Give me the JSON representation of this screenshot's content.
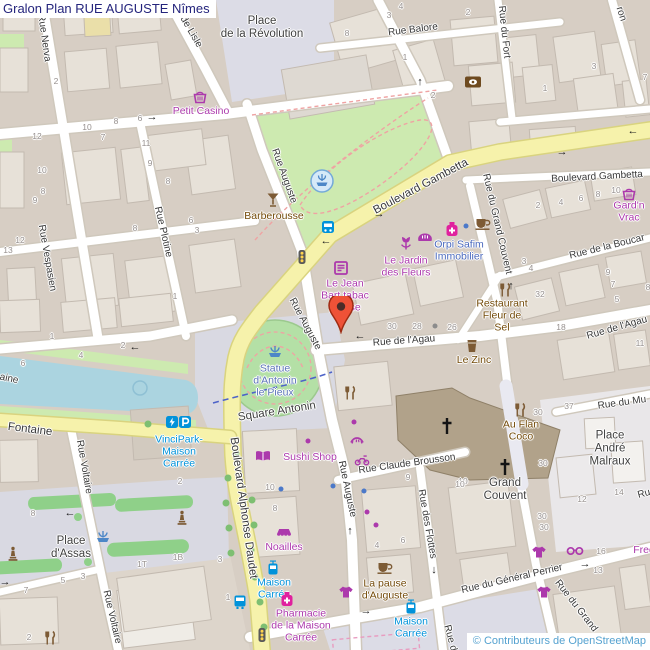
{
  "header": {
    "title": "Gralon Plan RUE AUGUSTE Nîmes"
  },
  "attribution": {
    "text": "© Contributeurs de OpenStreetMap"
  },
  "palette": {
    "shop": "#ac39ac",
    "amenity": "#734a08",
    "transit": "#0092da",
    "office": "#4a69bd",
    "tourism": "#5b74b8",
    "place": "#3f3f3f",
    "street": "#383838",
    "major": "#383838",
    "number": "#97918f",
    "title": "#24247c",
    "attribution": "#55a2d0",
    "road_major": "#f6f2ab",
    "water": "#abd4e0",
    "park": "#cdeab0",
    "plaza": "#dcdce6",
    "marker": "#ee5237"
  },
  "marker": {
    "name": "location-marker",
    "x": 341,
    "y": 332
  },
  "streets": [
    {
      "t": "Rue Nerva",
      "x": 44,
      "y": 38,
      "r": 82
    },
    {
      "t": "de Lisle",
      "x": 191,
      "y": 32,
      "r": 60
    },
    {
      "t": "Rue Balore",
      "x": 413,
      "y": 30,
      "r": -7
    },
    {
      "t": "Rue du Fort",
      "x": 504,
      "y": 32,
      "r": 84
    },
    {
      "t": "ron",
      "x": 621,
      "y": 14,
      "r": 72
    },
    {
      "t": "Boulevard Gambetta",
      "x": 421,
      "y": 187,
      "r": -28,
      "type": "major"
    },
    {
      "t": "Boulevard Gambetta",
      "x": 597,
      "y": 177,
      "r": -3
    },
    {
      "t": "Rue Auguste",
      "x": 284,
      "y": 176,
      "r": 70
    },
    {
      "t": "Rue Auguste",
      "x": 305,
      "y": 324,
      "r": 62
    },
    {
      "t": "Rue Auguste",
      "x": 347,
      "y": 489,
      "r": 78
    },
    {
      "t": "Rue Vespasien",
      "x": 47,
      "y": 258,
      "r": 80
    },
    {
      "t": "Rue Plotine",
      "x": 163,
      "y": 232,
      "r": 77
    },
    {
      "t": "Rue de l'Agau",
      "x": 404,
      "y": 341,
      "r": -4
    },
    {
      "t": "Rue de l'Agau",
      "x": 617,
      "y": 328,
      "r": -16
    },
    {
      "t": "Rue de la Boucar",
      "x": 607,
      "y": 247,
      "r": -14
    },
    {
      "t": "Rue du Grand Couvent",
      "x": 497,
      "y": 224,
      "r": 77
    },
    {
      "t": "Rue du Grand",
      "x": 576,
      "y": 606,
      "r": 52
    },
    {
      "t": "Rue du Mu",
      "x": 622,
      "y": 403,
      "r": -8
    },
    {
      "t": "Rue Claude Brousson",
      "x": 407,
      "y": 464,
      "r": -8
    },
    {
      "t": "Rue des Flottes",
      "x": 427,
      "y": 524,
      "r": 80
    },
    {
      "t": "Rue du Général Perrier",
      "x": 512,
      "y": 579,
      "r": -13
    },
    {
      "t": "Rue Voltaire",
      "x": 84,
      "y": 467,
      "r": 80
    },
    {
      "t": "Rue Voltaire",
      "x": 112,
      "y": 617,
      "r": 77
    },
    {
      "t": "Boulevard Alphonse Daudet",
      "x": 243,
      "y": 508,
      "r": 82,
      "type": "major"
    },
    {
      "t": "Fontaine",
      "x": 30,
      "y": 430,
      "r": 7,
      "type": "major"
    },
    {
      "t": "aine",
      "x": 9,
      "y": 379,
      "r": 12
    },
    {
      "t": "Square Antonin",
      "x": 277,
      "y": 412,
      "r": -9,
      "type": "place"
    },
    {
      "t": "Rue d",
      "x": 450,
      "y": 638,
      "r": 75
    },
    {
      "t": "Ru",
      "x": 644,
      "y": 494,
      "r": -15
    }
  ],
  "numbers": [
    {
      "n": "4",
      "x": 401,
      "y": 6
    },
    {
      "n": "3",
      "x": 389,
      "y": 15
    },
    {
      "n": "2",
      "x": 468,
      "y": 12
    },
    {
      "n": "8",
      "x": 347,
      "y": 33
    },
    {
      "n": "1",
      "x": 405,
      "y": 57
    },
    {
      "n": "2",
      "x": 433,
      "y": 95
    },
    {
      "n": "3",
      "x": 594,
      "y": 66
    },
    {
      "n": "1",
      "x": 545,
      "y": 88
    },
    {
      "n": "7",
      "x": 645,
      "y": 77
    },
    {
      "n": "2",
      "x": 56,
      "y": 81
    },
    {
      "n": "12",
      "x": 37,
      "y": 136
    },
    {
      "n": "10",
      "x": 87,
      "y": 127
    },
    {
      "n": "7",
      "x": 103,
      "y": 137
    },
    {
      "n": "8",
      "x": 116,
      "y": 121
    },
    {
      "n": "6",
      "x": 140,
      "y": 118
    },
    {
      "n": "11",
      "x": 146,
      "y": 143
    },
    {
      "n": "10",
      "x": 42,
      "y": 170
    },
    {
      "n": "8",
      "x": 43,
      "y": 191
    },
    {
      "n": "9",
      "x": 35,
      "y": 200
    },
    {
      "n": "12",
      "x": 20,
      "y": 240
    },
    {
      "n": "13",
      "x": 8,
      "y": 250
    },
    {
      "n": "9",
      "x": 150,
      "y": 163
    },
    {
      "n": "8",
      "x": 168,
      "y": 181
    },
    {
      "n": "6",
      "x": 191,
      "y": 220
    },
    {
      "n": "3",
      "x": 197,
      "y": 230
    },
    {
      "n": "8",
      "x": 135,
      "y": 228
    },
    {
      "n": "1",
      "x": 175,
      "y": 296
    },
    {
      "n": "2",
      "x": 538,
      "y": 205
    },
    {
      "n": "4",
      "x": 561,
      "y": 202
    },
    {
      "n": "6",
      "x": 581,
      "y": 198
    },
    {
      "n": "8",
      "x": 598,
      "y": 194
    },
    {
      "n": "10",
      "x": 616,
      "y": 190
    },
    {
      "n": "3",
      "x": 524,
      "y": 261
    },
    {
      "n": "4",
      "x": 531,
      "y": 268
    },
    {
      "n": "9",
      "x": 608,
      "y": 272
    },
    {
      "n": "7",
      "x": 613,
      "y": 284
    },
    {
      "n": "5",
      "x": 617,
      "y": 299
    },
    {
      "n": "8",
      "x": 648,
      "y": 287
    },
    {
      "n": "32",
      "x": 540,
      "y": 294
    },
    {
      "n": "18",
      "x": 561,
      "y": 327
    },
    {
      "n": "26",
      "x": 452,
      "y": 327
    },
    {
      "n": "30",
      "x": 392,
      "y": 326
    },
    {
      "n": "28",
      "x": 417,
      "y": 326
    },
    {
      "n": "11",
      "x": 640,
      "y": 343
    },
    {
      "n": "37",
      "x": 569,
      "y": 406
    },
    {
      "n": "30",
      "x": 538,
      "y": 412
    },
    {
      "n": "30",
      "x": 543,
      "y": 463
    },
    {
      "n": "10",
      "x": 463,
      "y": 481
    },
    {
      "n": "12",
      "x": 582,
      "y": 499
    },
    {
      "n": "14",
      "x": 619,
      "y": 492
    },
    {
      "n": "30",
      "x": 542,
      "y": 516
    },
    {
      "n": "30",
      "x": 544,
      "y": 527
    },
    {
      "n": "16",
      "x": 601,
      "y": 551
    },
    {
      "n": "13",
      "x": 598,
      "y": 570
    },
    {
      "n": "9",
      "x": 408,
      "y": 477
    },
    {
      "n": "10",
      "x": 460,
      "y": 484
    },
    {
      "n": "4",
      "x": 377,
      "y": 545
    },
    {
      "n": "6",
      "x": 403,
      "y": 540
    },
    {
      "n": "10",
      "x": 270,
      "y": 487
    },
    {
      "n": "8",
      "x": 275,
      "y": 508
    },
    {
      "n": "8",
      "x": 33,
      "y": 513
    },
    {
      "n": "2",
      "x": 180,
      "y": 481
    },
    {
      "n": "7",
      "x": 26,
      "y": 590
    },
    {
      "n": "5",
      "x": 63,
      "y": 580
    },
    {
      "n": "3",
      "x": 83,
      "y": 576
    },
    {
      "n": "1T",
      "x": 142,
      "y": 564
    },
    {
      "n": "1B",
      "x": 178,
      "y": 557
    },
    {
      "n": "3",
      "x": 220,
      "y": 559
    },
    {
      "n": "1",
      "x": 228,
      "y": 597
    },
    {
      "n": "2",
      "x": 29,
      "y": 637
    },
    {
      "n": "1",
      "x": 52,
      "y": 336
    },
    {
      "n": "2",
      "x": 123,
      "y": 345
    },
    {
      "n": "4",
      "x": 81,
      "y": 355
    },
    {
      "n": "6",
      "x": 23,
      "y": 363
    }
  ],
  "pois": [
    {
      "name": "poi-petit-casino",
      "lines": [
        "Petit Casino"
      ],
      "x": 201,
      "y": 112,
      "type": "shop"
    },
    {
      "name": "poi-gardn-vrac",
      "lines": [
        "Gard'n",
        "Vrac"
      ],
      "x": 629,
      "y": 212,
      "type": "shop"
    },
    {
      "name": "poi-barberousse",
      "lines": [
        "Barberousse"
      ],
      "x": 274,
      "y": 217,
      "type": "amenity"
    },
    {
      "name": "poi-jardin-des-fleurs",
      "lines": [
        "Le Jardin",
        "des Fleurs"
      ],
      "x": 406,
      "y": 267,
      "type": "shop"
    },
    {
      "name": "poi-orpi-safim",
      "lines": [
        "Orpi Safim",
        "Immobilier"
      ],
      "x": 459,
      "y": 251,
      "type": "office"
    },
    {
      "name": "poi-jean-bart-tabac",
      "lines": [
        "Le Jean",
        "Bart tabac",
        "presse"
      ],
      "x": 345,
      "y": 296,
      "type": "shop"
    },
    {
      "name": "poi-restaurant-fleur-de-sel",
      "lines": [
        "Restaurant",
        "Fleur de",
        "Sel"
      ],
      "x": 502,
      "y": 316,
      "type": "amenity"
    },
    {
      "name": "poi-le-zinc",
      "lines": [
        "Le Zinc"
      ],
      "x": 474,
      "y": 361,
      "type": "amenity"
    },
    {
      "name": "poi-au-flan-coco",
      "lines": [
        "Au Flan",
        "Coco"
      ],
      "x": 521,
      "y": 431,
      "type": "amenity"
    },
    {
      "name": "poi-grand-couvent",
      "lines": [
        "Grand",
        "Couvent"
      ],
      "x": 505,
      "y": 490,
      "type": "place"
    },
    {
      "name": "poi-place-andre-malraux",
      "lines": [
        "Place",
        "André",
        "Malraux"
      ],
      "x": 610,
      "y": 449,
      "type": "place"
    },
    {
      "name": "poi-place-de-la-revolution",
      "lines": [
        "Place",
        "de la Révolution"
      ],
      "x": 262,
      "y": 28,
      "type": "place"
    },
    {
      "name": "poi-place-d-assas",
      "lines": [
        "Place",
        "d'Assas"
      ],
      "x": 71,
      "y": 548,
      "type": "place"
    },
    {
      "name": "poi-statue-antonin",
      "lines": [
        "Statue",
        "d'Antonin",
        "le Pieux"
      ],
      "x": 275,
      "y": 381,
      "type": "tourism"
    },
    {
      "name": "poi-sushi-shop",
      "lines": [
        "Sushi Shop"
      ],
      "x": 310,
      "y": 458,
      "type": "shop"
    },
    {
      "name": "poi-noailles",
      "lines": [
        "Noailles"
      ],
      "x": 284,
      "y": 548,
      "type": "shop"
    },
    {
      "name": "poi-stop-maison-carree-1",
      "lines": [
        "Maison",
        "Carrée"
      ],
      "x": 274,
      "y": 589,
      "type": "transit"
    },
    {
      "name": "poi-stop-maison-carree-2",
      "lines": [
        "Maison",
        "Carrée"
      ],
      "x": 411,
      "y": 628,
      "type": "transit"
    },
    {
      "name": "poi-vincipark",
      "lines": [
        "VinciPark-",
        "Maison",
        "Carrée"
      ],
      "x": 179,
      "y": 452,
      "type": "transit"
    },
    {
      "name": "poi-pharmacie-maison-carree",
      "lines": [
        "Pharmacie",
        "de la Maison",
        "Carrée"
      ],
      "x": 301,
      "y": 626,
      "type": "shop"
    },
    {
      "name": "poi-la-pause-d-auguste",
      "lines": [
        "La pause",
        "d'Auguste"
      ],
      "x": 385,
      "y": 590,
      "type": "amenity"
    },
    {
      "name": "poi-fred",
      "lines": [
        "Fred"
      ],
      "x": 644,
      "y": 551,
      "type": "shop"
    }
  ],
  "icons": [
    {
      "name": "basket-icon",
      "x": 200,
      "y": 97
    },
    {
      "name": "basket-icon",
      "x": 629,
      "y": 194
    },
    {
      "name": "currency-icon",
      "x": 473,
      "y": 82
    },
    {
      "name": "cocktail-icon",
      "x": 273,
      "y": 200
    },
    {
      "name": "fountain-circled-icon",
      "x": 322,
      "y": 181
    },
    {
      "name": "fountain-icon",
      "x": 275,
      "y": 351
    },
    {
      "name": "fountain-icon",
      "x": 103,
      "y": 536
    },
    {
      "name": "bus-stop-icon",
      "x": 328,
      "y": 228
    },
    {
      "name": "bus-icon",
      "x": 240,
      "y": 602
    },
    {
      "name": "tram-icon",
      "x": 273,
      "y": 568
    },
    {
      "name": "tram-icon",
      "x": 411,
      "y": 607
    },
    {
      "name": "traffic-signals-icon",
      "x": 302,
      "y": 257
    },
    {
      "name": "traffic-signals-icon",
      "x": 262,
      "y": 635
    },
    {
      "name": "newspaper-icon",
      "x": 341,
      "y": 268
    },
    {
      "name": "flower-icon",
      "x": 406,
      "y": 243
    },
    {
      "name": "bakery-icon",
      "x": 425,
      "y": 237
    },
    {
      "name": "pharmacy-icon",
      "x": 452,
      "y": 229
    },
    {
      "name": "pharmacy-icon",
      "x": 287,
      "y": 599
    },
    {
      "name": "cafe-icon",
      "x": 483,
      "y": 224
    },
    {
      "name": "cafe-icon",
      "x": 385,
      "y": 568
    },
    {
      "name": "restaurant-icon",
      "x": 505,
      "y": 290
    },
    {
      "name": "restaurant-icon",
      "x": 520,
      "y": 410
    },
    {
      "name": "restaurant-icon",
      "x": 350,
      "y": 393
    },
    {
      "name": "restaurant-icon",
      "x": 50,
      "y": 638
    },
    {
      "name": "bar-icon",
      "x": 472,
      "y": 346
    },
    {
      "name": "books-icon",
      "x": 263,
      "y": 456
    },
    {
      "name": "awning-icon",
      "x": 284,
      "y": 533
    },
    {
      "name": "clothes-icon",
      "x": 346,
      "y": 592
    },
    {
      "name": "clothes-icon",
      "x": 539,
      "y": 552
    },
    {
      "name": "clothes-icon",
      "x": 544,
      "y": 592
    },
    {
      "name": "glasses-icon",
      "x": 575,
      "y": 551
    },
    {
      "name": "beauty-icon",
      "x": 357,
      "y": 440
    },
    {
      "name": "scooter-icon",
      "x": 362,
      "y": 460
    },
    {
      "name": "statue-icon",
      "x": 13,
      "y": 554
    },
    {
      "name": "statue-icon",
      "x": 182,
      "y": 518
    },
    {
      "name": "charging-icon",
      "x": 172,
      "y": 422
    },
    {
      "name": "parking-icon",
      "x": 185,
      "y": 422
    },
    {
      "name": "church-cross-icon",
      "x": 447,
      "y": 426
    },
    {
      "name": "church-cross-icon",
      "x": 505,
      "y": 467
    }
  ],
  "dots": [
    {
      "x": 308,
      "y": 441,
      "c": "#ac39ac"
    },
    {
      "x": 354,
      "y": 422,
      "c": "#ac39ac"
    },
    {
      "x": 367,
      "y": 512,
      "c": "#ac39ac"
    },
    {
      "x": 376,
      "y": 525,
      "c": "#ac39ac"
    },
    {
      "x": 281,
      "y": 489,
      "c": "#4c79c9"
    },
    {
      "x": 364,
      "y": 491,
      "c": "#4c79c9"
    },
    {
      "x": 333,
      "y": 486,
      "c": "#4c79c9"
    },
    {
      "x": 466,
      "y": 226,
      "c": "#4c79c9"
    },
    {
      "x": 435,
      "y": 326,
      "c": "#8c8c8c"
    }
  ],
  "arrows": [
    {
      "g": "→",
      "x": 152,
      "y": 117
    },
    {
      "g": "↑",
      "x": 420,
      "y": 82
    },
    {
      "g": "←",
      "x": 633,
      "y": 131
    },
    {
      "g": "→",
      "x": 562,
      "y": 152
    },
    {
      "g": "→",
      "x": 379,
      "y": 214
    },
    {
      "g": "←",
      "x": 326,
      "y": 241
    },
    {
      "g": "↑",
      "x": 511,
      "y": 286
    },
    {
      "g": "←",
      "x": 360,
      "y": 336
    },
    {
      "g": "←",
      "x": 135,
      "y": 347
    },
    {
      "g": "←",
      "x": 70,
      "y": 513
    },
    {
      "g": "→",
      "x": 5,
      "y": 582
    },
    {
      "g": "↑",
      "x": 350,
      "y": 531
    },
    {
      "g": "↓",
      "x": 434,
      "y": 570
    },
    {
      "g": "→",
      "x": 366,
      "y": 611
    },
    {
      "g": "→",
      "x": 585,
      "y": 564
    }
  ]
}
